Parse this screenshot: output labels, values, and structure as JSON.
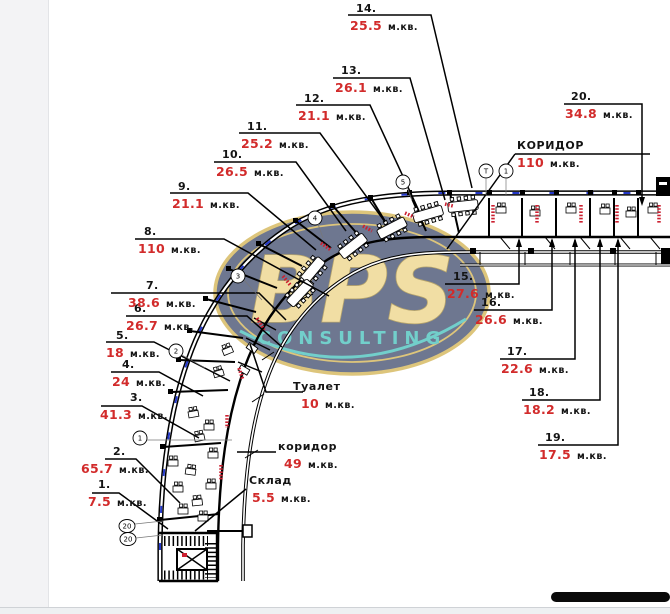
{
  "units_label": "м.кв.",
  "colors": {
    "area_value_red": "#d22b2b",
    "wall_black": "#000000",
    "window_dash_blue": "#2438c8",
    "radiator_red": "#cc2030",
    "watermark_navy": "#16254d",
    "watermark_gold": "#c9a22c",
    "watermark_teal": "#1db3ac"
  },
  "rooms": [
    {
      "num": "1.",
      "area": "7.5"
    },
    {
      "num": "2.",
      "area": "65.7"
    },
    {
      "num": "3.",
      "area": "41.3"
    },
    {
      "num": "4.",
      "area": "24"
    },
    {
      "num": "5.",
      "area": "18"
    },
    {
      "num": "6.",
      "area": "26.7"
    },
    {
      "num": "7.",
      "area": "38.6"
    },
    {
      "num": "8.",
      "area": "110"
    },
    {
      "num": "9.",
      "area": "21.1"
    },
    {
      "num": "10.",
      "area": "26.5"
    },
    {
      "num": "11.",
      "area": "25.2"
    },
    {
      "num": "12.",
      "area": "21.1"
    },
    {
      "num": "13.",
      "area": "26.1"
    },
    {
      "num": "14.",
      "area": "25.5"
    },
    {
      "num": "15.",
      "area": "27.6"
    },
    {
      "num": "16.",
      "area": "26.6"
    },
    {
      "num": "17.",
      "area": "22.6"
    },
    {
      "num": "18.",
      "area": "18.2"
    },
    {
      "num": "19.",
      "area": "17.5"
    },
    {
      "num": "20.",
      "area": "34.8"
    }
  ],
  "named_rooms": {
    "corridor_main": {
      "name": "КОРИДОР",
      "area": "110"
    },
    "toilet": {
      "name": "Туалет",
      "area": "10"
    },
    "corridor_small": {
      "name": "коридор",
      "area": "49"
    },
    "storage": {
      "name": "Склад",
      "area": "5.5"
    }
  },
  "markers": {
    "m1": "1",
    "m2": "2",
    "m3": "3",
    "m4": "4",
    "m5": "5",
    "mt": "Т",
    "m1b": "1",
    "m20a": "20",
    "m20b": "20"
  },
  "watermark": {
    "brand": "BPS",
    "subtitle": "CONSULTING"
  }
}
